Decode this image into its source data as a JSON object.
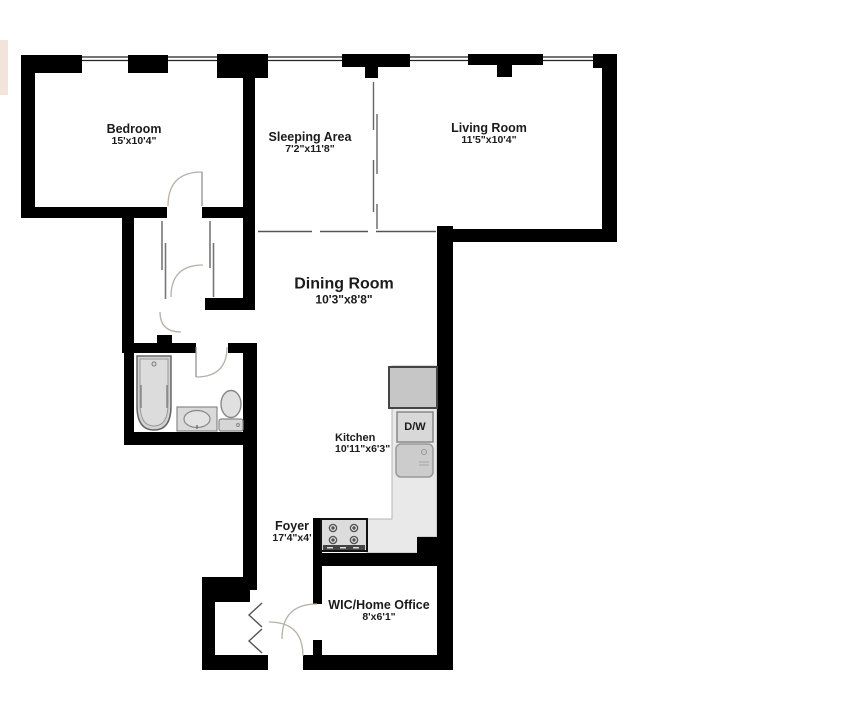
{
  "page": {
    "type": "apartment-floor-plan",
    "background": "#ffffff"
  },
  "rooms": [
    {
      "name": "Bedroom",
      "dims": "15'x10'4\""
    },
    {
      "name": "Sleeping Area",
      "dims": "7'2\"x11'8\""
    },
    {
      "name": "Living Room",
      "dims": "11'5\"x10'4\""
    },
    {
      "name": "Dining Room",
      "dims": "10'3\"x8'8\""
    },
    {
      "name": "Kitchen",
      "dims": "10'11\"x6'3\""
    },
    {
      "name": "Foyer",
      "dims": "17'4\"x4'"
    },
    {
      "name": "WIC/Home Office",
      "dims": "8'x6'1\""
    }
  ],
  "fixtures": {
    "dishwasher": "D/W"
  },
  "colors": {
    "wall": "#000000",
    "window_line": "#222222",
    "kitchen_floor": "#e9e9e9",
    "fixture_fill": "#d2d2d2",
    "door_arc": "#b8b0a6",
    "text": "#1b1b1b"
  }
}
